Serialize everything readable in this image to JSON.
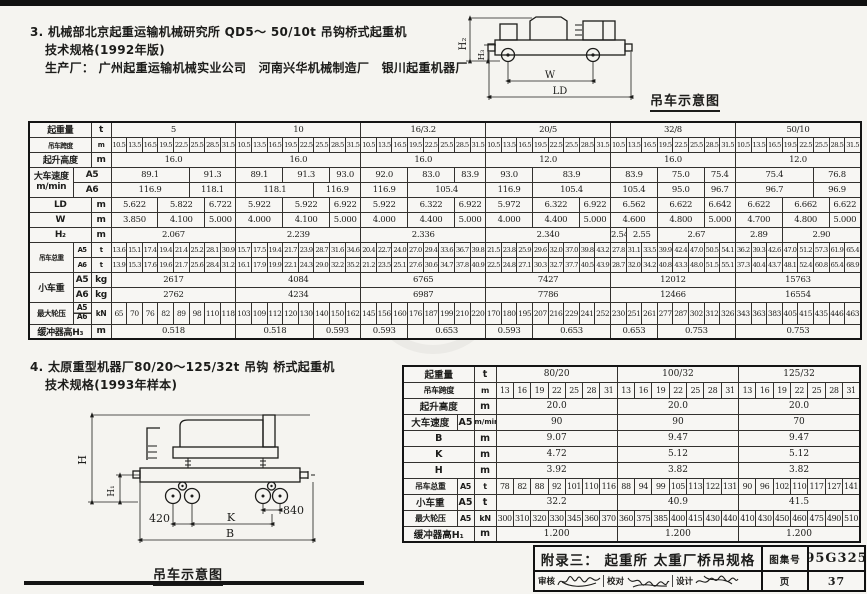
{
  "section3": {
    "line1": "3. 机械部北京起重运输机械研究所 QD5～ 50/10t 吊钩桥式起重机",
    "line2": "技术规格(1992年版)",
    "line3": "生产厂： 广州起重运输机械实业公司　河南兴华机械制造厂　银川起重机器厂"
  },
  "section4": {
    "line1": "4. 太原重型机器厂80/20～125/32t 吊钩 桥式起重机",
    "line2": "技术规格(1993年样本)"
  },
  "diagram_top": {
    "h2": "H₂",
    "h3": "H₃",
    "w": "W",
    "ld": "LD",
    "caption": "吊车示意图"
  },
  "diagram_bottom": {
    "h": "H",
    "h1": "H₁",
    "d420": "420",
    "d840": "840",
    "k": "K",
    "b": "B",
    "caption": "吊车示意图"
  },
  "table1": {
    "rows": [
      [
        [
          "起重量",
          2,
          1,
          "h"
        ],
        [
          "t",
          1,
          1,
          "h"
        ],
        [
          "5",
          8
        ],
        [
          "10",
          8
        ],
        [
          "16/3.2",
          8
        ],
        [
          "20/5",
          8
        ],
        [
          "32/8",
          8
        ],
        [
          "50/10",
          8
        ]
      ],
      [
        [
          "吊车跨度",
          2,
          1,
          "h"
        ],
        [
          "m",
          1,
          1,
          "h"
        ],
        "10.5",
        "13.5",
        "16.5",
        "19.5",
        "22.5",
        "25.5",
        "28.5",
        "31.5",
        "10.5",
        "13.5",
        "16.5",
        "19.5",
        "22.5",
        "25.5",
        "28.5",
        "31.5",
        "10.5",
        "13.5",
        "16.5",
        "19.5",
        "22.5",
        "25.5",
        "28.5",
        "31.5",
        "10.5",
        "13.5",
        "16.5",
        "19.5",
        "22.5",
        "25.5",
        "28.5",
        "31.5",
        "10.5",
        "13.5",
        "16.5",
        "19.5",
        "22.5",
        "25.5",
        "28.5",
        "31.5",
        "10.5",
        "13.5",
        "16.5",
        "19.5",
        "22.5",
        "25.5",
        "28.5",
        "31.5"
      ],
      [
        [
          "起升高度",
          2,
          1,
          "h"
        ],
        [
          "m",
          1,
          1,
          "h"
        ],
        [
          "16.0",
          8
        ],
        [
          "16.0",
          8
        ],
        [
          "16.0",
          8
        ],
        [
          "12.0",
          8
        ],
        [
          "16.0",
          8
        ],
        [
          "12.0",
          8
        ]
      ],
      [
        [
          "大车速度\nm/min",
          1,
          2,
          "h pre"
        ],
        [
          "A5",
          2,
          1,
          "h"
        ],
        [
          "89.1",
          5
        ],
        [
          "91.3",
          3
        ],
        [
          "89.1",
          3
        ],
        [
          "91.3",
          3
        ],
        [
          "93.0",
          2
        ],
        [
          "92.0",
          3
        ],
        [
          "83.0",
          3
        ],
        [
          "83.9",
          2
        ],
        [
          "93.0",
          3
        ],
        [
          "83.9",
          5
        ],
        [
          "83.9",
          3
        ],
        [
          "75.0",
          3
        ],
        [
          "75.4",
          2
        ],
        [
          "75.4",
          5
        ],
        [
          "76.8",
          3
        ]
      ],
      [
        [
          "A6",
          2,
          1,
          "h"
        ],
        [
          "116.9",
          5
        ],
        [
          "118.1",
          3
        ],
        [
          "118.1",
          5
        ],
        [
          "116.9",
          3
        ],
        [
          "116.9",
          3
        ],
        [
          "105.4",
          5
        ],
        [
          "116.9",
          3
        ],
        [
          "105.4",
          5
        ],
        [
          "105.4",
          3
        ],
        [
          "95.0",
          3
        ],
        [
          "96.7",
          2
        ],
        [
          "96.7",
          5
        ],
        [
          "96.9",
          3
        ]
      ],
      [
        [
          "LD",
          2,
          1,
          "h"
        ],
        [
          "m",
          1,
          1,
          "h"
        ],
        [
          "5.622",
          3
        ],
        [
          "5.822",
          3
        ],
        [
          "6.722",
          2
        ],
        [
          "5.922",
          3
        ],
        [
          "5.922",
          3
        ],
        [
          "6.922",
          2
        ],
        [
          "5.922",
          3
        ],
        [
          "6.322",
          3
        ],
        [
          "6.922",
          2
        ],
        [
          "5.972",
          3
        ],
        [
          "6.322",
          3
        ],
        [
          "6.922",
          2
        ],
        [
          "6.562",
          3
        ],
        [
          "6.622",
          3
        ],
        [
          "6.642",
          2
        ],
        [
          "6.622",
          3
        ],
        [
          "6.662",
          3
        ],
        [
          "6.622",
          2
        ]
      ],
      [
        [
          "W",
          2,
          1,
          "h"
        ],
        [
          "m",
          1,
          1,
          "h"
        ],
        [
          "3.850",
          3
        ],
        [
          "4.100",
          3
        ],
        [
          "5.000",
          2
        ],
        [
          "4.000",
          3
        ],
        [
          "4.100",
          3
        ],
        [
          "5.000",
          2
        ],
        [
          "4.000",
          3
        ],
        [
          "4.400",
          3
        ],
        [
          "5.000",
          2
        ],
        [
          "4.000",
          3
        ],
        [
          "4.400",
          3
        ],
        [
          "5.000",
          2
        ],
        [
          "4.600",
          3
        ],
        [
          "4.800",
          3
        ],
        [
          "5.000",
          2
        ],
        [
          "4.700",
          3
        ],
        [
          "4.800",
          3
        ],
        [
          "5.000",
          2
        ]
      ],
      [
        [
          "H₂",
          2,
          1,
          "h"
        ],
        [
          "m",
          1,
          1,
          "h"
        ],
        [
          "2.067",
          8
        ],
        [
          "2.239",
          8
        ],
        [
          "2.336",
          8
        ],
        [
          "2.340",
          8
        ],
        [
          "2.54",
          1
        ],
        [
          "2.55",
          2
        ],
        [
          "2.67",
          5
        ],
        [
          "2.89",
          3
        ],
        [
          "2.90",
          5
        ]
      ],
      [
        [
          "吊车总重",
          1,
          2,
          "h"
        ],
        [
          "A5",
          1,
          1,
          "h"
        ],
        [
          "t",
          1,
          1,
          "h"
        ],
        "13.6",
        "15.1",
        "17.4",
        "19.4",
        "21.4",
        "25.2",
        "28.1",
        "30.9",
        "15.7",
        "17.5",
        "19.4",
        "21.7",
        "23.9",
        "28.7",
        "31.6",
        "34.6",
        "20.4",
        "22.7",
        "24.0",
        "27.0",
        "29.4",
        "33.6",
        "36.7",
        "39.8",
        "21.5",
        "23.8",
        "25.9",
        "29.6",
        "32.0",
        "37.0",
        "39.8",
        "43.2",
        "27.8",
        "31.1",
        "33.5",
        "39.9",
        "42.4",
        "47.0",
        "50.5",
        "54.1",
        "36.2",
        "39.3",
        "42.6",
        "47.0",
        "51.2",
        "57.3",
        "61.9",
        "65.4"
      ],
      [
        [
          "A6",
          1,
          1,
          "h"
        ],
        [
          "t",
          1,
          1,
          "h"
        ],
        "13.9",
        "15.3",
        "17.6",
        "19.6",
        "21.7",
        "25.6",
        "28.4",
        "31.2",
        "16.1",
        "17.9",
        "19.9",
        "22.1",
        "24.3",
        "29.0",
        "32.2",
        "35.2",
        "21.2",
        "23.5",
        "25.1",
        "27.6",
        "30.6",
        "34.7",
        "37.8",
        "40.9",
        "22.5",
        "24.8",
        "27.1",
        "30.3",
        "32.7",
        "37.7",
        "40.5",
        "43.9",
        "28.7",
        "32.0",
        "34.2",
        "40.8",
        "43.3",
        "48.0",
        "51.5",
        "55.1",
        "37.3",
        "40.4",
        "43.7",
        "48.1",
        "52.4",
        "60.8",
        "65.4",
        "68.9"
      ],
      [
        [
          "小车重",
          1,
          2,
          "h"
        ],
        [
          "A5",
          1,
          1,
          "h"
        ],
        [
          "kg",
          1,
          1,
          "h"
        ],
        [
          "2617",
          8
        ],
        [
          "4084",
          8
        ],
        [
          "6765",
          8
        ],
        [
          "7427",
          8
        ],
        [
          "12012",
          8
        ],
        [
          "15763",
          8
        ]
      ],
      [
        [
          "A6",
          1,
          1,
          "h"
        ],
        [
          "kg",
          1,
          1,
          "h"
        ],
        [
          "2762",
          8
        ],
        [
          "4234",
          8
        ],
        [
          "6987",
          8
        ],
        [
          "7786",
          8
        ],
        [
          "12466",
          8
        ],
        [
          "16554",
          8
        ]
      ],
      [
        [
          "最大轮压",
          1,
          1,
          "h"
        ],
        [
          "A5\nA6",
          1,
          1,
          "h pre sm split"
        ],
        [
          "kN",
          1,
          1,
          "h"
        ],
        "65",
        "70",
        "76",
        "82",
        "89",
        "98",
        "110",
        "118",
        "103",
        "109",
        "112",
        "120",
        "130",
        "140",
        "150",
        "162",
        "145",
        "156",
        "160",
        "176",
        "187",
        "199",
        "210",
        "220",
        "170",
        "180",
        "195",
        "207",
        "216",
        "229",
        "241",
        "252",
        "230",
        "251",
        "261",
        "277",
        "287",
        "302",
        "312",
        "326",
        "343",
        "363",
        "383",
        "405",
        "415",
        "435",
        "446",
        "463"
      ],
      [
        [
          "缓冲器高H₃",
          2,
          1,
          "h"
        ],
        [
          "m",
          1,
          1,
          "h"
        ],
        [
          "0.518",
          8
        ],
        [
          "0.518",
          5
        ],
        [
          "0.593",
          3
        ],
        [
          "0.593",
          3
        ],
        [
          "0.653",
          5
        ],
        [
          "0.593",
          3
        ],
        [
          "0.653",
          5
        ],
        [
          "0.653",
          3
        ],
        [
          "0.753",
          5
        ],
        [
          "0.753",
          8
        ]
      ]
    ]
  },
  "table2": {
    "rows": [
      [
        [
          "起重量",
          2,
          1,
          "h"
        ],
        [
          "t",
          1,
          1,
          "h"
        ],
        [
          "80/20",
          7
        ],
        [
          "100/32",
          7
        ],
        [
          "125/32",
          7
        ]
      ],
      [
        [
          "吊车跨度",
          2,
          1,
          "h"
        ],
        [
          "m",
          1,
          1,
          "h"
        ],
        "13",
        "16",
        "19",
        "22",
        "25",
        "28",
        "31",
        "13",
        "16",
        "19",
        "22",
        "25",
        "28",
        "31",
        "13",
        "16",
        "19",
        "22",
        "25",
        "28",
        "31"
      ],
      [
        [
          "起升高度",
          2,
          1,
          "h"
        ],
        [
          "m",
          1,
          1,
          "h"
        ],
        [
          "20.0",
          7
        ],
        [
          "20.0",
          7
        ],
        [
          "20.0",
          7
        ]
      ],
      [
        [
          "大车速度",
          1,
          1,
          "h"
        ],
        [
          "A5",
          1,
          1,
          "h"
        ],
        [
          "m/min",
          1,
          1,
          "h sm"
        ],
        [
          "90",
          7
        ],
        [
          "90",
          7
        ],
        [
          "70",
          7
        ]
      ],
      [
        [
          "B",
          2,
          1,
          "h"
        ],
        [
          "m",
          1,
          1,
          "h"
        ],
        [
          "9.07",
          7
        ],
        [
          "9.47",
          7
        ],
        [
          "9.47",
          7
        ]
      ],
      [
        [
          "K",
          2,
          1,
          "h"
        ],
        [
          "m",
          1,
          1,
          "h"
        ],
        [
          "4.72",
          7
        ],
        [
          "5.12",
          7
        ],
        [
          "5.12",
          7
        ]
      ],
      [
        [
          "H",
          2,
          1,
          "h"
        ],
        [
          "m",
          1,
          1,
          "h"
        ],
        [
          "3.92",
          7
        ],
        [
          "3.82",
          7
        ],
        [
          "3.82",
          7
        ]
      ],
      [
        [
          "吊车总重",
          1,
          1,
          "h"
        ],
        [
          "A5",
          1,
          1,
          "h"
        ],
        [
          "t",
          1,
          1,
          "h"
        ],
        "78",
        "82",
        "88",
        "92",
        "101",
        "110",
        "116",
        "88",
        "94",
        "99",
        "105",
        "113",
        "122",
        "131",
        "90",
        "96",
        "102",
        "110",
        "117",
        "127",
        "141"
      ],
      [
        [
          "小车重",
          1,
          1,
          "h"
        ],
        [
          "A5",
          1,
          1,
          "h"
        ],
        [
          "t",
          1,
          1,
          "h"
        ],
        [
          "32.2",
          7
        ],
        [
          "40.9",
          7
        ],
        [
          "41.5",
          7
        ]
      ],
      [
        [
          "最大轮压",
          1,
          1,
          "h"
        ],
        [
          "A5",
          1,
          1,
          "h"
        ],
        [
          "kN",
          1,
          1,
          "h"
        ],
        "300",
        "310",
        "320",
        "330",
        "345",
        "360",
        "370",
        "360",
        "375",
        "385",
        "400",
        "415",
        "430",
        "440",
        "410",
        "430",
        "450",
        "460",
        "475",
        "490",
        "510"
      ],
      [
        [
          "缓冲器高H₁",
          2,
          1,
          "h"
        ],
        [
          "m",
          1,
          1,
          "h"
        ],
        [
          "1.200",
          7
        ],
        [
          "1.200",
          7
        ],
        [
          "1.200",
          7
        ]
      ]
    ]
  },
  "titleblock": {
    "appendix": "附录三：  起重所 太重厂桥吊规格",
    "atlas_label": "图集号",
    "atlas_no": "95G325",
    "review_label": "审核",
    "check_label": "校对",
    "design_label": "设计",
    "page_label": "页",
    "page_no": "37"
  }
}
